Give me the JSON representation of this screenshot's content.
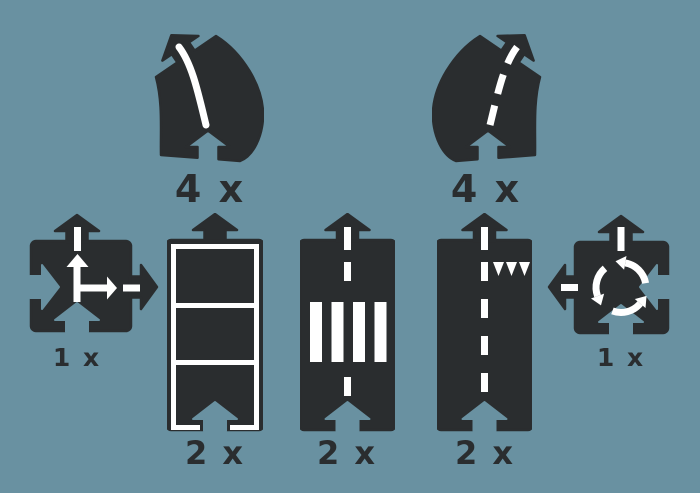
{
  "colors": {
    "background": "#6991A1",
    "piece": "#2A2D2F",
    "marking": "#FFFFFF"
  },
  "pieces": [
    {
      "id": "curve-solid-line",
      "label": "4 x"
    },
    {
      "id": "curve-dashed-line",
      "label": "4 x"
    },
    {
      "id": "crossroad-intersection",
      "label": "1 x"
    },
    {
      "id": "straight-lane-sections",
      "label": "2 x"
    },
    {
      "id": "straight-zebra-crossing",
      "label": "2 x"
    },
    {
      "id": "straight-dashed-yield",
      "label": "2 x"
    },
    {
      "id": "roundabout",
      "label": "1 x"
    }
  ]
}
